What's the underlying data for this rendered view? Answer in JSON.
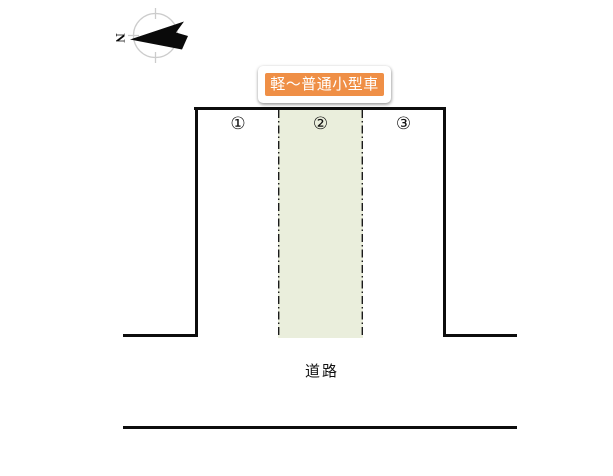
{
  "diagram": {
    "type": "parking-layout",
    "compass": {
      "north_letter": "N"
    },
    "tooltip": {
      "text": "軽〜普通小型車",
      "background": "#ef8f46",
      "text_color": "#ffffff"
    },
    "parking": {
      "spaces": [
        {
          "number": "①",
          "highlighted": false
        },
        {
          "number": "②",
          "highlighted": true
        },
        {
          "number": "③",
          "highlighted": false
        }
      ],
      "highlight_color": "#eaeedc",
      "divider_style": "dash-dot"
    },
    "road_label": "道路",
    "line_color": "#0d0d0d",
    "compass_ring_color": "#cccccc"
  }
}
